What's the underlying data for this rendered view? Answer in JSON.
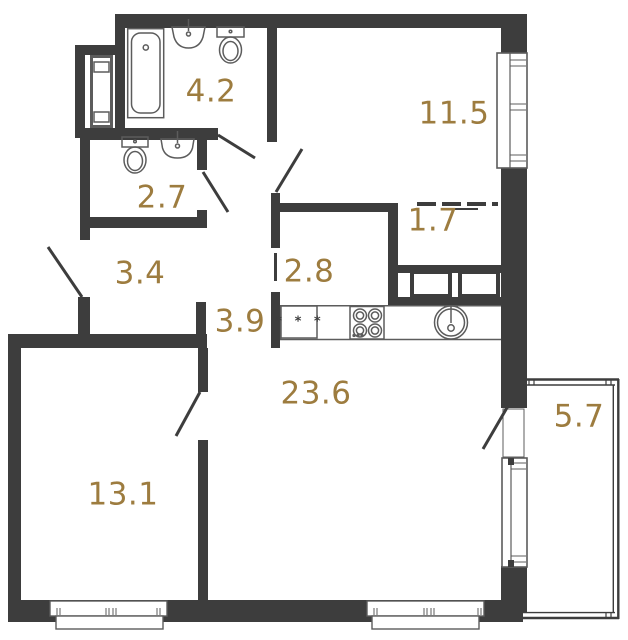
{
  "plan_title": "apartment-floor-plan",
  "rooms": [
    {
      "name": "bathroom",
      "area": "4.2"
    },
    {
      "name": "room",
      "area": "11.5"
    },
    {
      "name": "wc",
      "area": "2.7"
    },
    {
      "name": "wardrobe",
      "area": "1.7"
    },
    {
      "name": "hallway",
      "area": "3.4"
    },
    {
      "name": "hall",
      "area": "2.8"
    },
    {
      "name": "corridor",
      "area": "3.9"
    },
    {
      "name": "kitchen-living-room",
      "area": "23.6"
    },
    {
      "name": "bedroom",
      "area": "13.1"
    },
    {
      "name": "balcony",
      "area": "5.7"
    }
  ],
  "kitchen": {
    "appliance_marks": "* * *"
  },
  "colors": {
    "wall": "#3d3d3d",
    "label": "#9d7c3f",
    "fixture": "#5c5c5c",
    "background": "#ffffff"
  }
}
